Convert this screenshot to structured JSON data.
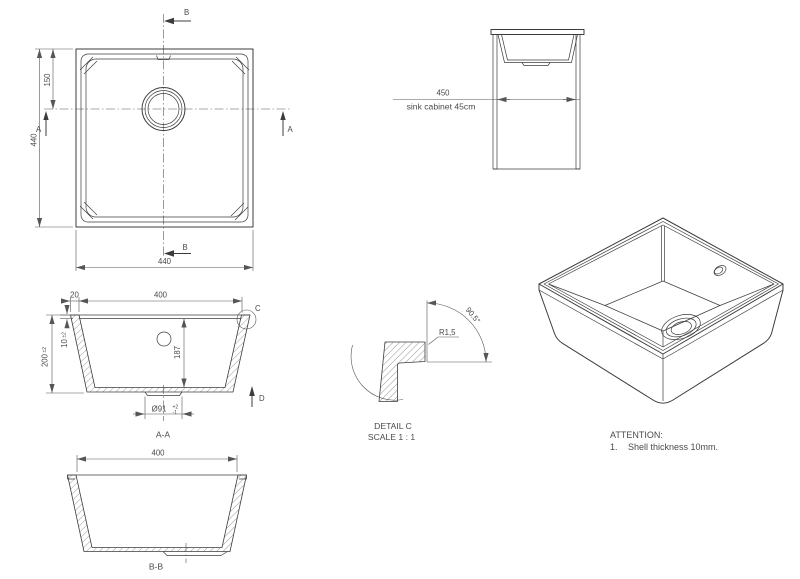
{
  "colors": {
    "background": "#ffffff",
    "line": "#3c3c3c",
    "dimension": "#565656",
    "text": "#4a4a4a"
  },
  "plan_view": {
    "dim_overall_height": "440",
    "dim_drain_offset": "150",
    "dim_overall_width": "440",
    "section_b_top": "B",
    "section_b_bottom": "B",
    "section_a_left": "A",
    "section_a_right": "A"
  },
  "cabinet_view": {
    "dim_width": "450",
    "note": "sink cabinet 45cm"
  },
  "section_aa": {
    "dim_rim": "20",
    "dim_inner_width": "400",
    "dim_height": "200",
    "dim_height_tol": "±2",
    "dim_thickness": "10",
    "dim_thickness_tol": "±2",
    "dim_depth": "187",
    "dim_drain_dia": "Ø91",
    "dim_drain_tol_upper": "+2",
    "dim_drain_tol_lower": "-1",
    "detail_marker": "C",
    "view_arrow": "D",
    "label": "A-A"
  },
  "section_bb": {
    "dim_inner_width": "400",
    "label": "B-B"
  },
  "detail_c": {
    "angle": "90.5°",
    "radius": "R1,5",
    "title": "DETAIL C",
    "scale": "SCALE 1 : 1"
  },
  "attention": {
    "heading": "ATTENTION:",
    "item_number": "1.",
    "item_text": "Shell thickness 10mm."
  }
}
